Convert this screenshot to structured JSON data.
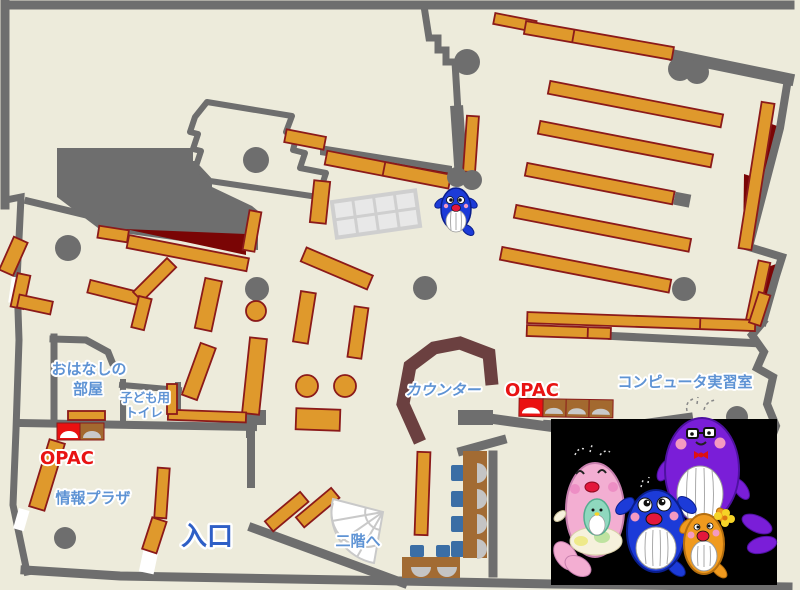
{
  "page": {
    "type": "library-floor-map"
  },
  "labels": {
    "storytelling_1": "おはなしの",
    "storytelling_2": "部屋",
    "kids_toilet_1": "子ども用",
    "kids_toilet_2": "トイレ",
    "opac_left": "OPAC",
    "opac_right": "OPAC",
    "info_plaza": "情報プラザ",
    "entrance": "入口",
    "to_second_floor": "二階へ",
    "counter": "カウンター",
    "computer_room": "コンピュータ実習室"
  },
  "colors": {
    "floor": "#EDEBDB",
    "wall": "#6E6E6E",
    "shelf": "#DF992C",
    "shelf_border": "#8B1A1A",
    "accent_dark_red": "#7A0505",
    "counter": "#6B4040",
    "table": "#A26B33",
    "chair": "#3B6EA5",
    "seat": "#C4C4C4",
    "opac_red": "#EA1111",
    "label_blue": "#5E93D4",
    "entrance_blue": "#2E5FC6",
    "photo_background": "#000000",
    "mascot_blue": "#1C3BD8",
    "mascot_pink": "#F3AED2",
    "mascot_purple": "#7A1ED8",
    "mascot_orange": "#F09A1E",
    "mascot_baby_green": "#8FD8BE"
  },
  "icons": {
    "stairs": "fan-stairs-icon",
    "opac_terminal": "opac-terminal-icon",
    "whale_mascot": "whale-mascot",
    "whale_family_photo": "whale-family-photo"
  }
}
